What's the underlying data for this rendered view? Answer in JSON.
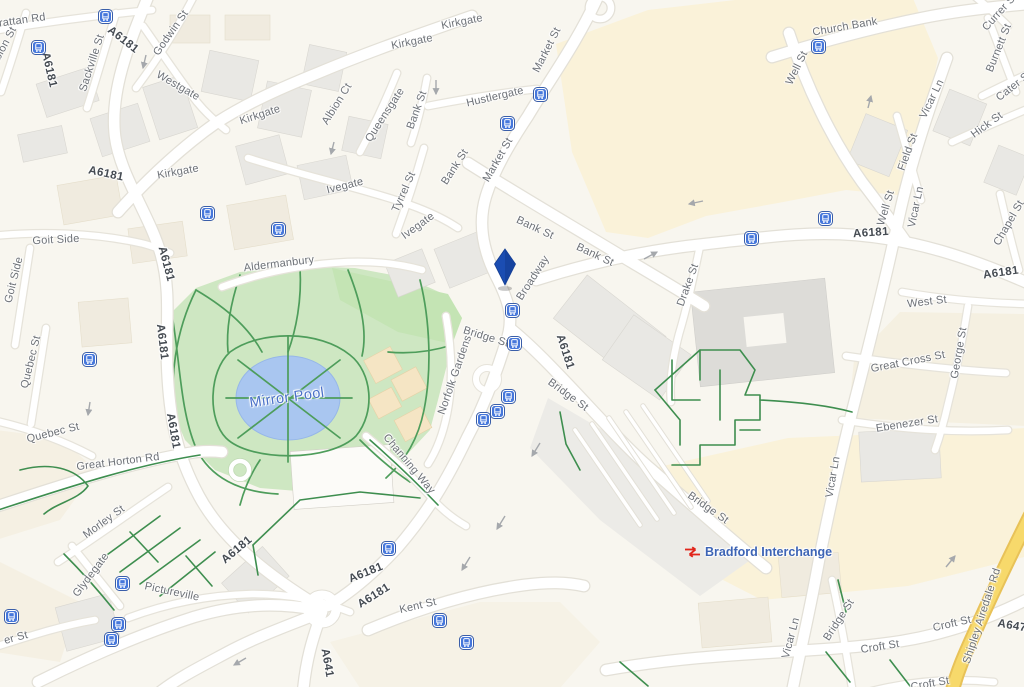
{
  "map": {
    "description": "Street map of Bradford city centre around Mirror Pool and Bradford Interchange",
    "station": {
      "label": "Bradford Interchange"
    },
    "pin": {
      "name": "selected-location-pin",
      "x": 505,
      "y": 287
    },
    "colors": {
      "background": "#F8F6EF",
      "area_of_interest": "#FAF2D9",
      "building_grey": "#E9E8E4",
      "building_cream": "#F0EBDF",
      "road_fill": "#FFFFFF",
      "road_casing": "#E3E0D7",
      "park_fill": "#CEE7C2",
      "park_fill_bright": "#C4E4B4",
      "park_path_green": "#4E9D5B",
      "water_fill": "#A9C6F0",
      "water_label_blue": "#4A70C8",
      "yellow_road": "#F7D96B",
      "bus_icon_blue": "#4677DB",
      "pin_blue": "#1B4DB2",
      "rail_icon_red": "#E1251B",
      "station_label_blue": "#3D64B5",
      "street_label_grey": "#6D7177",
      "route_label_grey": "#454B52"
    },
    "labels": [
      {
        "t": "A6181",
        "x": 123,
        "y": 40,
        "r": 38,
        "c": "route"
      },
      {
        "t": "A6181",
        "x": 49,
        "y": 70,
        "r": 77,
        "c": "route"
      },
      {
        "t": "A6181",
        "x": 106,
        "y": 174,
        "r": 12,
        "c": "route"
      },
      {
        "t": "A6181",
        "x": 166,
        "y": 264,
        "r": 75,
        "c": "route"
      },
      {
        "t": "A6181",
        "x": 162,
        "y": 342,
        "r": 83,
        "c": "route"
      },
      {
        "t": "A6181",
        "x": 173,
        "y": 431,
        "r": 80,
        "c": "route"
      },
      {
        "t": "A6181",
        "x": 565,
        "y": 352,
        "r": 72,
        "c": "route"
      },
      {
        "t": "A6181",
        "x": 871,
        "y": 233,
        "r": -4,
        "c": "route"
      },
      {
        "t": "A6181",
        "x": 1001,
        "y": 273,
        "r": -8,
        "c": "route"
      },
      {
        "t": "A6181",
        "x": 237,
        "y": 550,
        "r": -40,
        "c": "route"
      },
      {
        "t": "A6181",
        "x": 366,
        "y": 573,
        "r": -22,
        "c": "route"
      },
      {
        "t": "A6181",
        "x": 374,
        "y": 596,
        "r": -32,
        "c": "route"
      },
      {
        "t": "A641",
        "x": 327,
        "y": 663,
        "r": 80,
        "c": "route"
      },
      {
        "t": "A647",
        "x": 1012,
        "y": 626,
        "r": 10,
        "c": "route"
      },
      {
        "t": "Grattan Rd",
        "x": 18,
        "y": 21,
        "r": -8,
        "c": "street"
      },
      {
        "t": "Albion St",
        "x": 3,
        "y": 48,
        "r": -62,
        "c": "street"
      },
      {
        "t": "Godwin St",
        "x": 171,
        "y": 33,
        "r": -55,
        "c": "street"
      },
      {
        "t": "Sackville St",
        "x": 92,
        "y": 63,
        "r": -72,
        "c": "street"
      },
      {
        "t": "Westgate",
        "x": 178,
        "y": 86,
        "r": 30,
        "c": "street"
      },
      {
        "t": "Kirkgate",
        "x": 260,
        "y": 115,
        "r": -18,
        "c": "street"
      },
      {
        "t": "Kirkgate",
        "x": 178,
        "y": 172,
        "r": -10,
        "c": "street"
      },
      {
        "t": "Kirkgate",
        "x": 412,
        "y": 42,
        "r": -11,
        "c": "street"
      },
      {
        "t": "Kirkgate",
        "x": 462,
        "y": 22,
        "r": -11,
        "c": "street"
      },
      {
        "t": "Albion Ct",
        "x": 337,
        "y": 104,
        "r": -58,
        "c": "street"
      },
      {
        "t": "Queensgate",
        "x": 385,
        "y": 115,
        "r": -57,
        "c": "street"
      },
      {
        "t": "Bank St",
        "x": 417,
        "y": 110,
        "r": -70,
        "c": "street"
      },
      {
        "t": "Bank St",
        "x": 455,
        "y": 167,
        "r": -57,
        "c": "street"
      },
      {
        "t": "Bank St",
        "x": 535,
        "y": 228,
        "r": 25,
        "c": "street"
      },
      {
        "t": "Bank St",
        "x": 595,
        "y": 255,
        "r": 25,
        "c": "street"
      },
      {
        "t": "Hustlergate",
        "x": 495,
        "y": 97,
        "r": -13,
        "c": "street"
      },
      {
        "t": "Market St",
        "x": 547,
        "y": 50,
        "r": -63,
        "c": "street"
      },
      {
        "t": "Market St",
        "x": 498,
        "y": 160,
        "r": -60,
        "c": "street"
      },
      {
        "t": "Ivegate",
        "x": 345,
        "y": 186,
        "r": -14,
        "c": "street"
      },
      {
        "t": "Ivegate",
        "x": 418,
        "y": 226,
        "r": -36,
        "c": "street"
      },
      {
        "t": "Tyrrel St",
        "x": 404,
        "y": 192,
        "r": -66,
        "c": "street"
      },
      {
        "t": "Church Bank",
        "x": 845,
        "y": 27,
        "r": -10,
        "c": "street"
      },
      {
        "t": "Well St",
        "x": 797,
        "y": 68,
        "r": -64,
        "c": "street"
      },
      {
        "t": "Well St",
        "x": 886,
        "y": 208,
        "r": -73,
        "c": "street"
      },
      {
        "t": "Vicar Ln",
        "x": 932,
        "y": 99,
        "r": -64,
        "c": "street"
      },
      {
        "t": "Vicar Ln",
        "x": 916,
        "y": 207,
        "r": -78,
        "c": "street"
      },
      {
        "t": "Vicar Ln",
        "x": 833,
        "y": 477,
        "r": -80,
        "c": "street"
      },
      {
        "t": "Vicar Ln",
        "x": 791,
        "y": 638,
        "r": -75,
        "c": "street"
      },
      {
        "t": "Burnett St",
        "x": 999,
        "y": 48,
        "r": -68,
        "c": "street"
      },
      {
        "t": "Currer St",
        "x": 1000,
        "y": 12,
        "r": -48,
        "c": "street"
      },
      {
        "t": "Cater St",
        "x": 1014,
        "y": 86,
        "r": -38,
        "c": "street"
      },
      {
        "t": "Hick St",
        "x": 987,
        "y": 125,
        "r": -36,
        "c": "street"
      },
      {
        "t": "Field St",
        "x": 908,
        "y": 152,
        "r": -70,
        "c": "street"
      },
      {
        "t": "Chapel St",
        "x": 1009,
        "y": 223,
        "r": -60,
        "c": "street"
      },
      {
        "t": "West St",
        "x": 927,
        "y": 302,
        "r": -7,
        "c": "street"
      },
      {
        "t": "George St",
        "x": 959,
        "y": 353,
        "r": -80,
        "c": "street"
      },
      {
        "t": "Great Cross St",
        "x": 908,
        "y": 362,
        "r": -11,
        "c": "street"
      },
      {
        "t": "Ebenezer St",
        "x": 907,
        "y": 424,
        "r": -9,
        "c": "street"
      },
      {
        "t": "Drake St",
        "x": 688,
        "y": 285,
        "r": -70,
        "c": "street"
      },
      {
        "t": "Broadway",
        "x": 533,
        "y": 278,
        "r": -57,
        "c": "street"
      },
      {
        "t": "Bridge St",
        "x": 486,
        "y": 337,
        "r": 17,
        "c": "street"
      },
      {
        "t": "Bridge St",
        "x": 568,
        "y": 395,
        "r": 36,
        "c": "street"
      },
      {
        "t": "Bridge St",
        "x": 708,
        "y": 508,
        "r": 35,
        "c": "street"
      },
      {
        "t": "Bridge St",
        "x": 839,
        "y": 620,
        "r": -57,
        "c": "street"
      },
      {
        "t": "Croft St",
        "x": 880,
        "y": 647,
        "r": -9,
        "c": "street"
      },
      {
        "t": "Croft St",
        "x": 952,
        "y": 624,
        "r": -13,
        "c": "street"
      },
      {
        "t": "Croft St",
        "x": 930,
        "y": 684,
        "r": -10,
        "c": "street"
      },
      {
        "t": "Shipley Airedale Rd",
        "x": 982,
        "y": 616,
        "r": -72,
        "c": "street"
      },
      {
        "t": "Kent St",
        "x": 418,
        "y": 606,
        "r": -13,
        "c": "street"
      },
      {
        "t": "Pictureville",
        "x": 172,
        "y": 592,
        "r": 12,
        "c": "street"
      },
      {
        "t": "Glydegate",
        "x": 91,
        "y": 575,
        "r": -53,
        "c": "street"
      },
      {
        "t": "Morley St",
        "x": 104,
        "y": 522,
        "r": -36,
        "c": "street"
      },
      {
        "t": "Great Horton Rd",
        "x": 118,
        "y": 462,
        "r": -7,
        "c": "street"
      },
      {
        "t": "Quebec St",
        "x": 31,
        "y": 362,
        "r": -76,
        "c": "street"
      },
      {
        "t": "Quebec St",
        "x": 53,
        "y": 433,
        "r": -14,
        "c": "street"
      },
      {
        "t": "Goit Side",
        "x": 56,
        "y": 240,
        "r": -3,
        "c": "street"
      },
      {
        "t": "Goit Side",
        "x": 14,
        "y": 280,
        "r": -76,
        "c": "street"
      },
      {
        "t": "Aldermanbury",
        "x": 279,
        "y": 264,
        "r": -7,
        "c": "street"
      },
      {
        "t": "Norfolk Gardens",
        "x": 455,
        "y": 375,
        "r": -71,
        "c": "street"
      },
      {
        "t": "Channing Way",
        "x": 409,
        "y": 464,
        "r": 50,
        "c": "street"
      },
      {
        "t": "er St",
        "x": 16,
        "y": 638,
        "r": -15,
        "c": "street"
      },
      {
        "t": "Mirror Pool",
        "x": 287,
        "y": 398,
        "r": -8,
        "c": "water"
      }
    ],
    "bus_stops": [
      {
        "x": 105,
        "y": 16
      },
      {
        "x": 38,
        "y": 47
      },
      {
        "x": 540,
        "y": 94
      },
      {
        "x": 507,
        "y": 123
      },
      {
        "x": 818,
        "y": 46
      },
      {
        "x": 825,
        "y": 218
      },
      {
        "x": 751,
        "y": 238
      },
      {
        "x": 207,
        "y": 213
      },
      {
        "x": 278,
        "y": 229
      },
      {
        "x": 512,
        "y": 310
      },
      {
        "x": 514,
        "y": 343
      },
      {
        "x": 508,
        "y": 396
      },
      {
        "x": 497,
        "y": 411
      },
      {
        "x": 483,
        "y": 419
      },
      {
        "x": 89,
        "y": 359
      },
      {
        "x": 11,
        "y": 616
      },
      {
        "x": 122,
        "y": 583
      },
      {
        "x": 118,
        "y": 624
      },
      {
        "x": 111,
        "y": 639
      },
      {
        "x": 388,
        "y": 548
      },
      {
        "x": 439,
        "y": 620
      },
      {
        "x": 466,
        "y": 642
      }
    ]
  }
}
